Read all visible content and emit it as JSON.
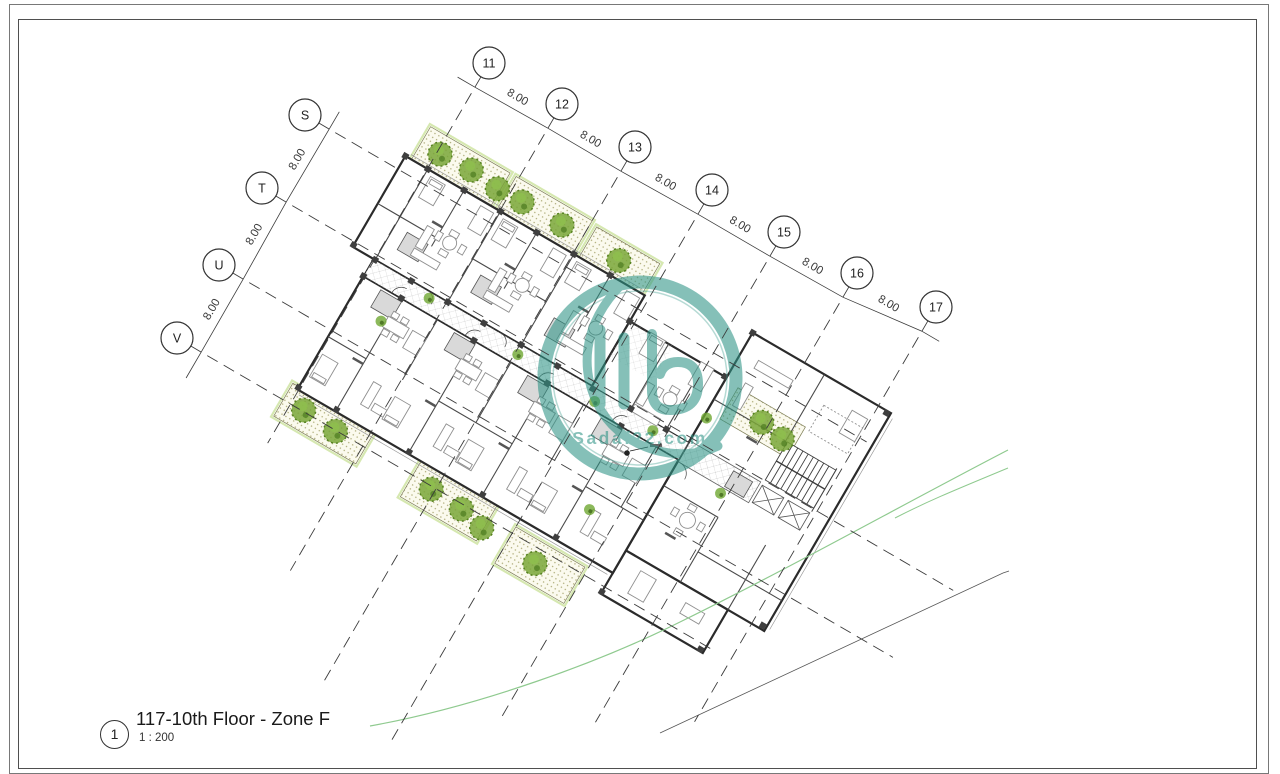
{
  "title_block": {
    "detail_number": "1",
    "title": "117-10th Floor - Zone F",
    "scale": "1 : 200"
  },
  "watermark": {
    "text": "Sadaf22.com",
    "color": "#2E9486"
  },
  "grid": {
    "top_bubbles": [
      {
        "label": "11",
        "x": 489,
        "y": 63
      },
      {
        "label": "12",
        "x": 562,
        "y": 104
      },
      {
        "label": "13",
        "x": 635,
        "y": 147
      },
      {
        "label": "14",
        "x": 712,
        "y": 190
      },
      {
        "label": "15",
        "x": 784,
        "y": 232
      },
      {
        "label": "16",
        "x": 857,
        "y": 273
      },
      {
        "label": "17",
        "x": 936,
        "y": 307
      }
    ],
    "left_bubbles": [
      {
        "label": "S",
        "x": 305,
        "y": 115
      },
      {
        "label": "T",
        "x": 262,
        "y": 188
      },
      {
        "label": "U",
        "x": 219,
        "y": 265
      },
      {
        "label": "V",
        "x": 177,
        "y": 338
      }
    ],
    "top_dim_labels": [
      "8.00",
      "8.00",
      "8.00",
      "8.00",
      "8.00",
      "8.00"
    ],
    "left_dim_labels": [
      "8.00",
      "8.00",
      "8.00"
    ]
  }
}
